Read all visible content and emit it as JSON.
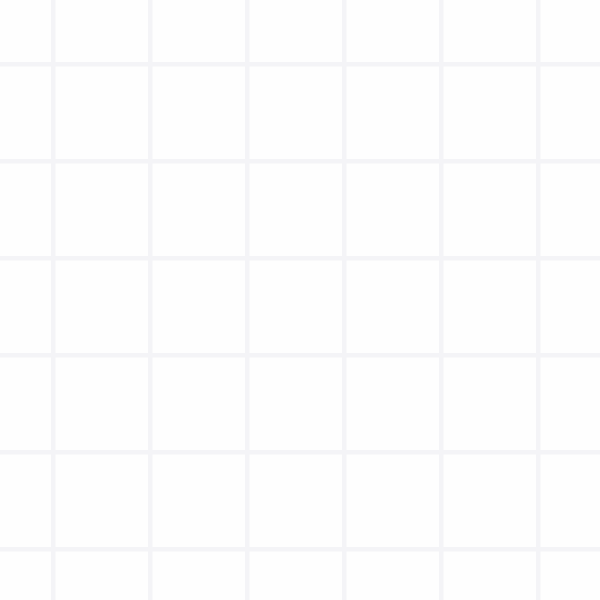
{
  "scene": {
    "description": "factory game viewport: conveyor belts feeding two 2-lane balancer machines",
    "canvas": {
      "width": 600,
      "height": 600
    },
    "palette": {
      "background": "#fefefe",
      "grid_line": "#f4f4f7",
      "belt": "#d1d1d6",
      "belt_edge": "#a8a8b0",
      "belt_arrow": "#c1c1c8",
      "machine_body": "#73737b",
      "machine_border": "#56565e",
      "machine_arrow": "#7c7c84",
      "pipe_outline": "#5c5c64",
      "pipe_core": "#73737b",
      "connector_slot": "#80808a",
      "item_shadow": "rgba(118,118,142,0.20)",
      "square_fill": "#b2b0ac",
      "square_border": "#54565a",
      "green_fill": "#4ee24f",
      "green_border": "#3c4347"
    },
    "grid": {
      "size": 97,
      "offset_x": 53,
      "offset_y": 64,
      "line_width": 4.5
    },
    "belt_width": 74,
    "belt_arrow_spacing": 32.5,
    "belts": [
      {
        "id": "belt-1-top",
        "x": 104,
        "y1": 0,
        "y2": 277
      },
      {
        "id": "belt-1-bottom",
        "x": 104,
        "y1": 342,
        "y2": 600
      },
      {
        "id": "belt-2-input-pad",
        "x": 201,
        "y1": 258,
        "y2": 277
      },
      {
        "id": "belt-2-bottom",
        "x": 202,
        "y1": 342,
        "y2": 600
      },
      {
        "id": "belt-3-top",
        "x": 392,
        "y1": 0,
        "y2": 277
      },
      {
        "id": "belt-3-output-stub",
        "x": 392,
        "y1": 342,
        "y2": 356
      },
      {
        "id": "belt-4-top",
        "x": 490,
        "y1": 0,
        "y2": 277
      },
      {
        "id": "belt-4-bottom",
        "x": 490,
        "y1": 342,
        "y2": 600
      }
    ],
    "machines": [
      {
        "id": "balancer-left",
        "lane_left": 104,
        "lane_right": 201,
        "top": 277,
        "bottom": 342
      },
      {
        "id": "balancer-right",
        "lane_left": 392,
        "lane_right": 490,
        "top": 277,
        "bottom": 342
      }
    ],
    "items": [
      {
        "type": "green",
        "x": 104,
        "y": 33
      },
      {
        "type": "square",
        "x": 104,
        "y": 97
      },
      {
        "type": "green",
        "x": 104,
        "y": 165
      },
      {
        "type": "square",
        "x": 104,
        "y": 229
      },
      {
        "type": "green",
        "x": 104,
        "y": 263
      },
      {
        "type": "green",
        "x": 203,
        "y": 256
      },
      {
        "type": "square",
        "x": 392,
        "y": 67
      },
      {
        "type": "square",
        "x": 393,
        "y": 268
      },
      {
        "type": "square",
        "x": 490,
        "y": 177
      },
      {
        "type": "green",
        "x": 104,
        "y": 392
      },
      {
        "type": "green",
        "x": 104,
        "y": 455
      },
      {
        "type": "green",
        "x": 104,
        "y": 517
      },
      {
        "type": "green",
        "x": 104,
        "y": 578
      },
      {
        "type": "square",
        "x": 202,
        "y": 392
      },
      {
        "type": "square",
        "x": 202,
        "y": 452
      },
      {
        "type": "square",
        "x": 202,
        "y": 512
      },
      {
        "type": "square",
        "x": 202,
        "y": 574
      },
      {
        "type": "square",
        "x": 490,
        "y": 388
      },
      {
        "type": "square",
        "x": 490,
        "y": 481
      },
      {
        "type": "square",
        "x": 490,
        "y": 589
      }
    ],
    "offscreen_item_shadows": [
      {
        "x": 392,
        "y": -22
      },
      {
        "x": 490,
        "y": -25
      }
    ]
  }
}
